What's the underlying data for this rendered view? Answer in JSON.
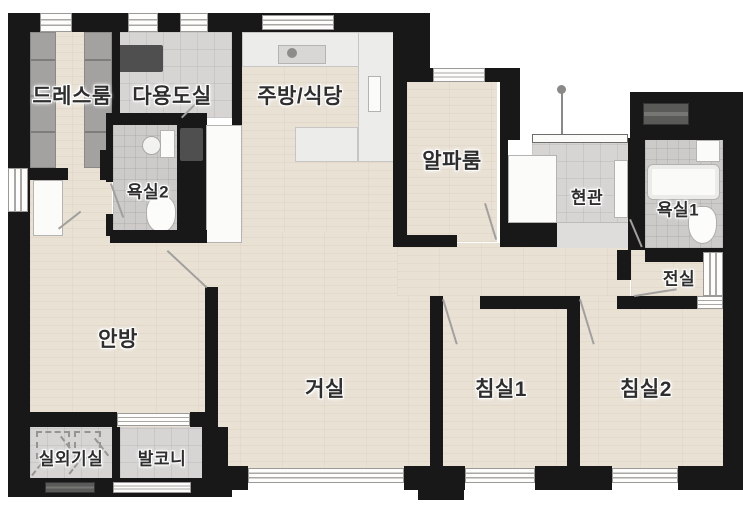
{
  "floorplan": {
    "title": "apartment-floor-plan",
    "rooms": [
      {
        "id": "dress-room",
        "label": "드레스룸"
      },
      {
        "id": "utility-room",
        "label": "다용도실"
      },
      {
        "id": "kitchen-dining",
        "label": "주방/식당"
      },
      {
        "id": "alpha-room",
        "label": "알파룸"
      },
      {
        "id": "entrance",
        "label": "현관"
      },
      {
        "id": "bathroom-1",
        "label": "욕실1"
      },
      {
        "id": "bathroom-2",
        "label": "욕실2"
      },
      {
        "id": "front-room",
        "label": "전실"
      },
      {
        "id": "master-bedroom",
        "label": "안방"
      },
      {
        "id": "living-room",
        "label": "거실"
      },
      {
        "id": "bedroom-1",
        "label": "침실1"
      },
      {
        "id": "bedroom-2",
        "label": "침실2"
      },
      {
        "id": "outdoor-unit-room",
        "label": "실외기실"
      },
      {
        "id": "balcony",
        "label": "발코니"
      }
    ],
    "colors": {
      "wall": "#181818",
      "wood_floor": "#e9e1d4",
      "tile_floor": "#d6d5d3",
      "bath_tile": "#cccbc9",
      "counter": "#ececea",
      "background": "#ffffff",
      "label_text": "#2e2e2e"
    }
  }
}
